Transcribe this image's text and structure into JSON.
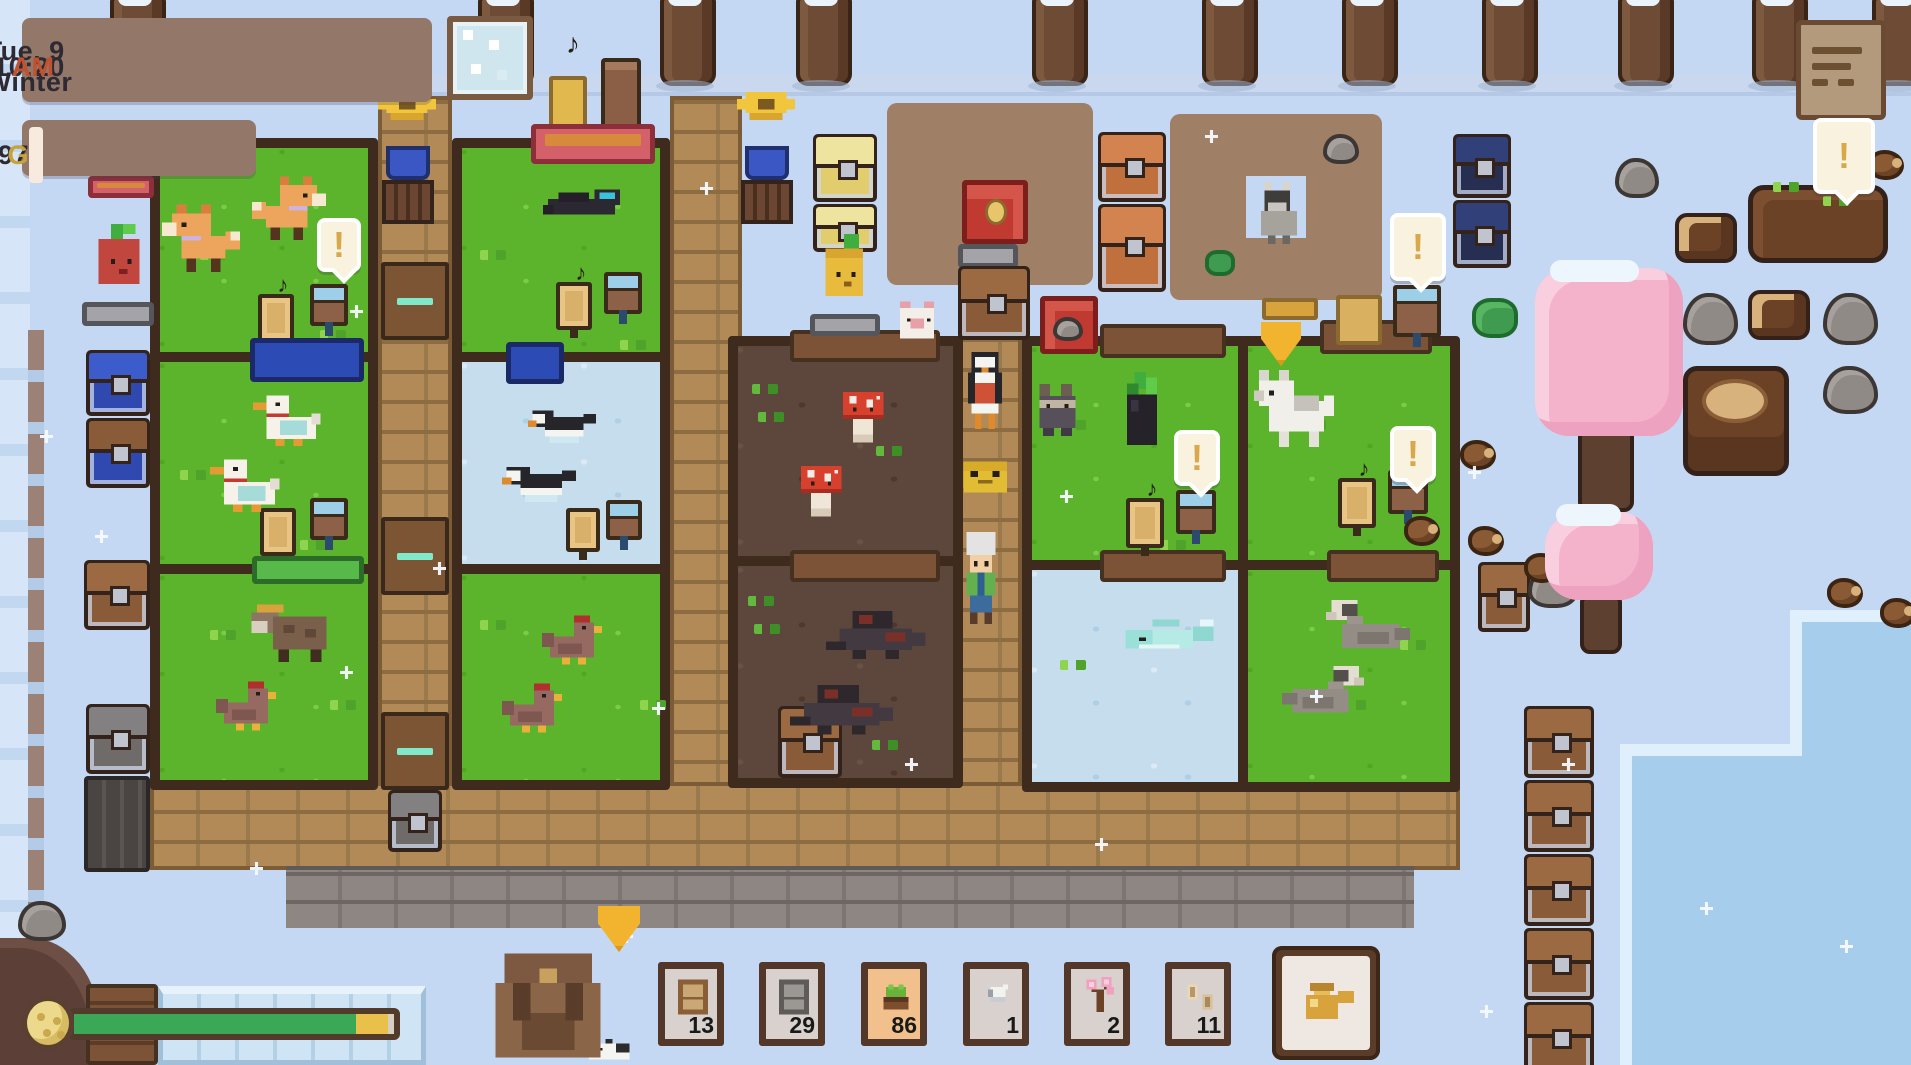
{
  "hud": {
    "date": "Tue, 9 Winter",
    "time": "10:20",
    "meridiem": "AM",
    "money": "356997",
    "currency": "G"
  },
  "energy": {
    "percent": 88,
    "tip_percent": 10
  },
  "hotbar": {
    "slots": [
      {
        "icon": "wooden-door-item",
        "count": "13",
        "selected": false
      },
      {
        "icon": "stone-door-item",
        "count": "29",
        "selected": false
      },
      {
        "icon": "feed-trough-item",
        "count": "86",
        "selected": true
      },
      {
        "icon": "white-flower-item",
        "count": "1",
        "selected": false
      },
      {
        "icon": "sakura-sapling-item",
        "count": "2",
        "selected": false
      },
      {
        "icon": "seed-pouch-item",
        "count": "11",
        "selected": false
      }
    ]
  },
  "glyphs": {
    "exclamation": "!",
    "music_note": "♪"
  },
  "colors": {
    "meridiem": "#c1512f",
    "currency_gold": "#c9a23a",
    "selected_slot": "#f2c08c",
    "energy_green": "#3aa857",
    "energy_tip": "#e8c04a",
    "gate_mint": "#7fe9c9",
    "background": "#c4d8f3",
    "grass": "#5cb42d",
    "path_brown": "#b18a58"
  }
}
